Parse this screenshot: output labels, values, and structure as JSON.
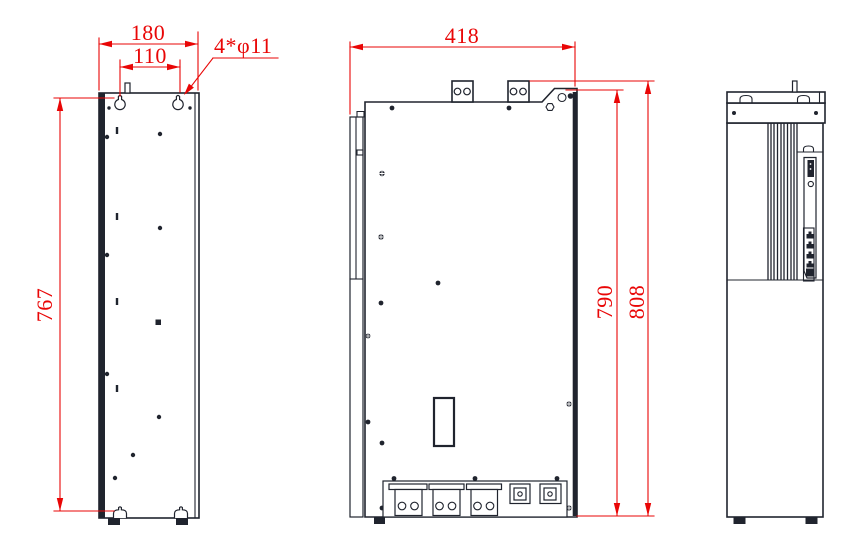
{
  "colors": {
    "ink": "#20242e",
    "dimension_red": "#e90606",
    "background": "#ffffff"
  },
  "dimensions": {
    "left_view_width": "180",
    "left_view_hole_spacing": "110",
    "mounting_holes_note": "4*φ11",
    "left_view_height": "767",
    "front_view_width": "418",
    "front_view_height_to_ledge": "790",
    "front_view_overall_height": "808"
  }
}
